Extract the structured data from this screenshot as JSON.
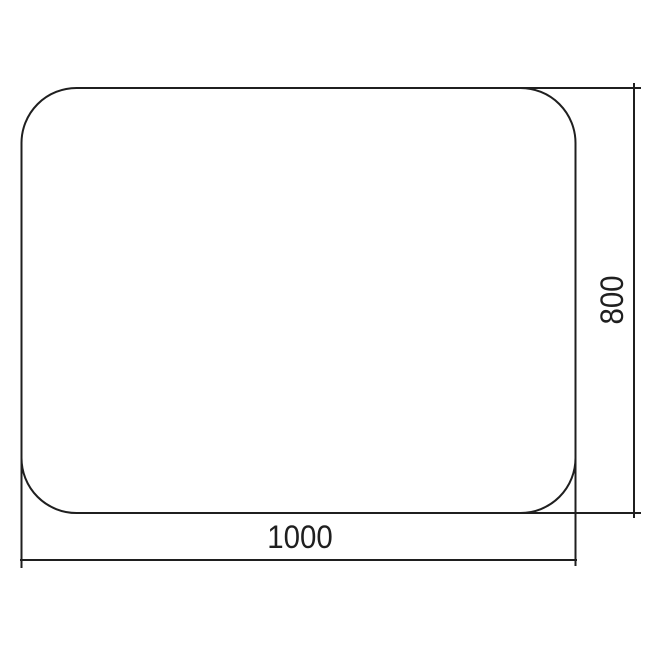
{
  "drawing": {
    "type": "dimensioned-technical-drawing",
    "shape": "rounded-rectangle",
    "dimensions": {
      "width_label": "1000",
      "height_label": "800"
    },
    "line_color": "#1f1f1f",
    "text_color": "#1f1f1f",
    "background_color": "#ffffff"
  }
}
